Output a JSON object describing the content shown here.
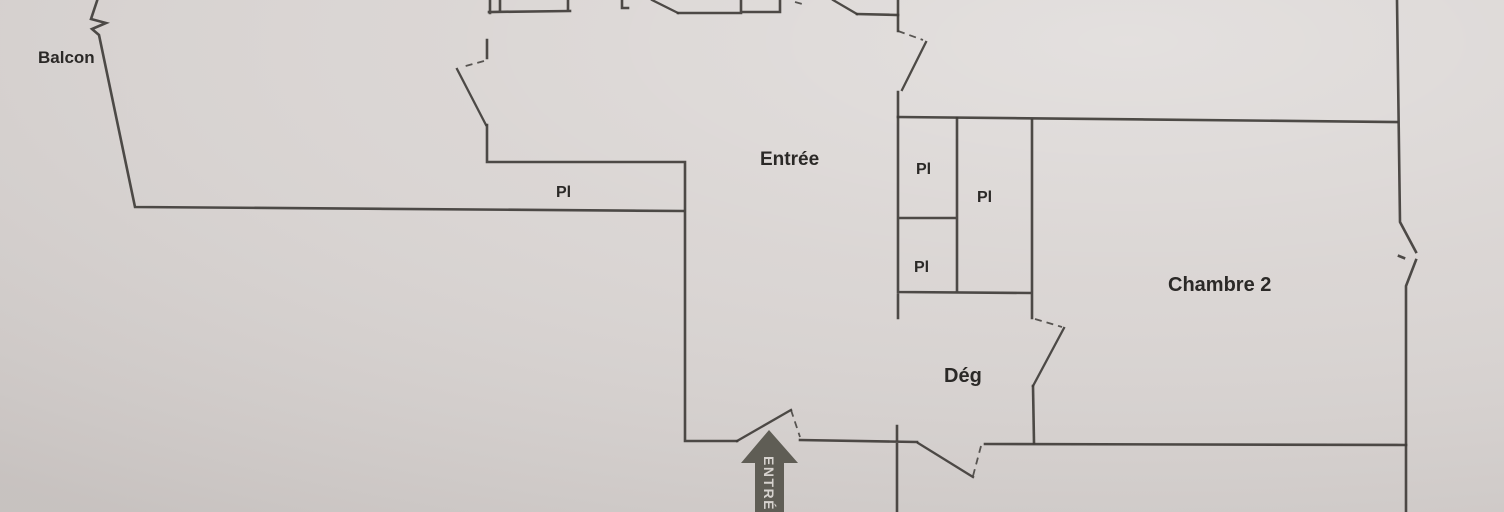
{
  "document": {
    "type": "apartment floor plan photo"
  },
  "colors": {
    "paper": "#d8d3d1",
    "line": "#403d3a",
    "text": "#2b2927",
    "arrow": "#5f5d55",
    "arrow_text": "#d6d2ce"
  },
  "rooms": {
    "balcony": {
      "label": "Balcon"
    },
    "entrance_hall": {
      "label": "Entrée"
    },
    "hallway": {
      "label": "Dég"
    },
    "bedroom2": {
      "label": "Chambre 2"
    }
  },
  "closets": {
    "closet_entrance": {
      "label": "Pl"
    },
    "closet_upper": {
      "label": "Pl"
    },
    "closet_right": {
      "label": "Pl"
    },
    "closet_lower": {
      "label": "Pl"
    }
  },
  "entry_arrow": {
    "label": "ENTRÉE"
  }
}
